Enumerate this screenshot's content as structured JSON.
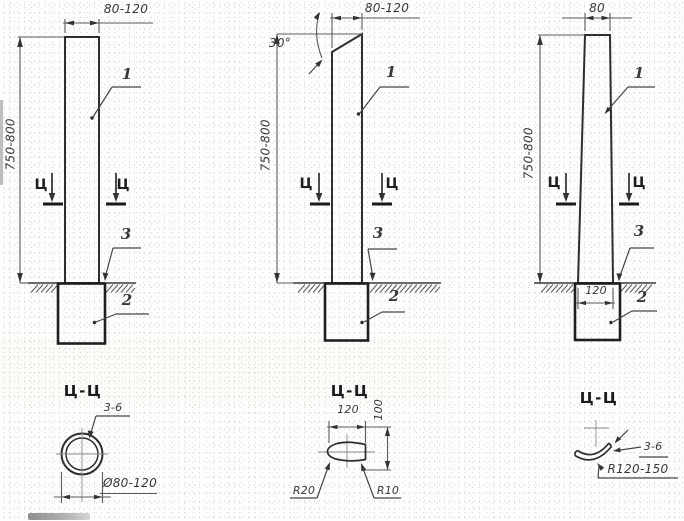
{
  "colors": {
    "ink": "#2e2e2e",
    "paper": "#fdfdfb"
  },
  "figures": [
    {
      "name": "tube-post",
      "labels": {
        "top_width": "80-120",
        "height": "750-800",
        "pole": "1",
        "footing": "2",
        "ground_line": "3",
        "marker_left": "Ц",
        "marker_right": "Ц"
      },
      "section": {
        "title": "Ц-Ц",
        "wall_thickness": "3-6",
        "diameter": "Ø80-120"
      }
    },
    {
      "name": "teardrop-post",
      "labels": {
        "top_width": "80-120",
        "height": "750-800",
        "top_bevel_angle": "30°",
        "pole": "1",
        "footing": "2",
        "ground_line": "3",
        "marker_left": "Ц",
        "marker_right": "Ц"
      },
      "section": {
        "title": "Ц-Ц",
        "width": "120",
        "height": "100",
        "radius_left": "R20",
        "radius_right": "R10"
      }
    },
    {
      "name": "curved-plate-post",
      "labels": {
        "top_width": "80",
        "base_width": "120",
        "height": "750-800",
        "pole": "1",
        "footing": "2",
        "ground_line": "3",
        "marker_left": "Ц",
        "marker_right": "Ц"
      },
      "section": {
        "title": "Ц-Ц",
        "plate_thickness": "3-6",
        "radius": "R120-150"
      }
    }
  ]
}
